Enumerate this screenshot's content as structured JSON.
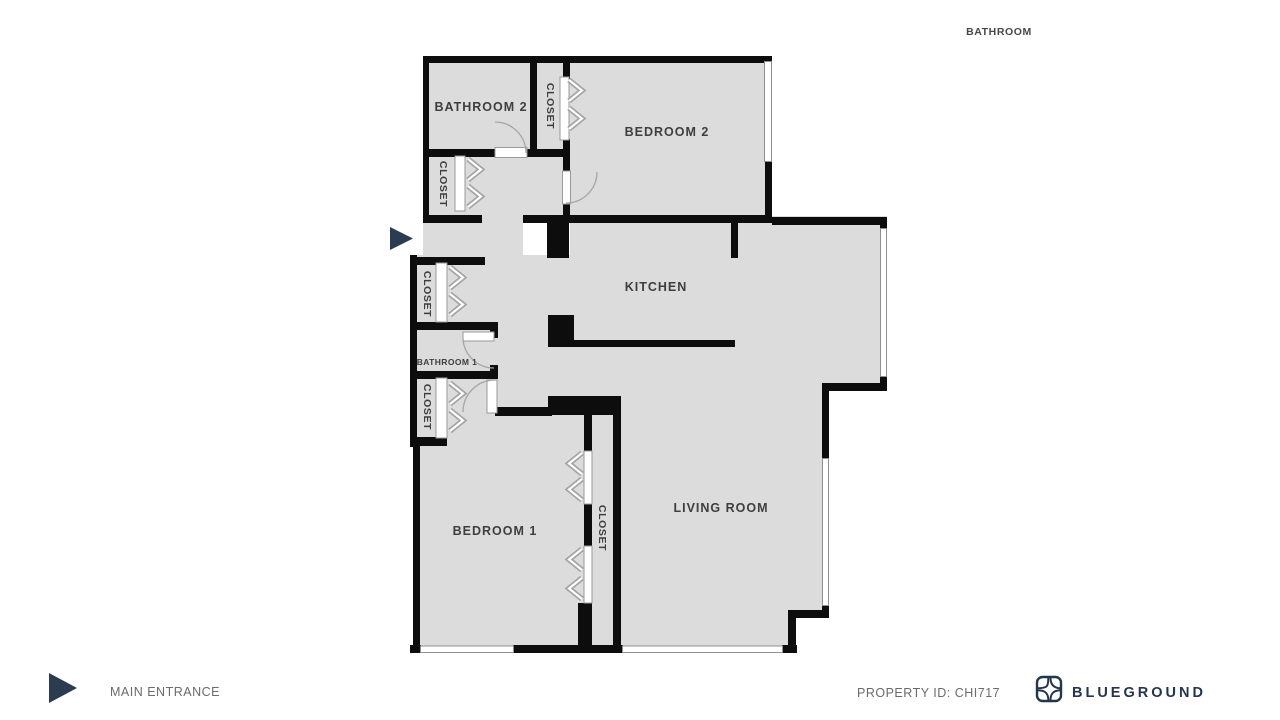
{
  "plan": {
    "labels": {
      "bathroom2": "BATHROOM 2",
      "bedroom2": "BEDROOM 2",
      "kitchen": "KITCHEN",
      "bathroom1": "BATHROOM 1",
      "bedroom1": "BEDROOM 1",
      "living_room": "LIVING ROOM",
      "closet": "CLOSET",
      "stray_bathroom": "BATHROOM"
    },
    "colors": {
      "room_fill": "#dcdcdc",
      "wall": "#0d0d0d",
      "window_stroke": "#8f8f8f",
      "door_stroke": "#a6a6a6",
      "accent_navy": "#2b3b52"
    }
  },
  "footer": {
    "main_entrance": "MAIN ENTRANCE",
    "property_id": "PROPERTY ID: CHI717",
    "brand": "BLUEGROUND"
  }
}
